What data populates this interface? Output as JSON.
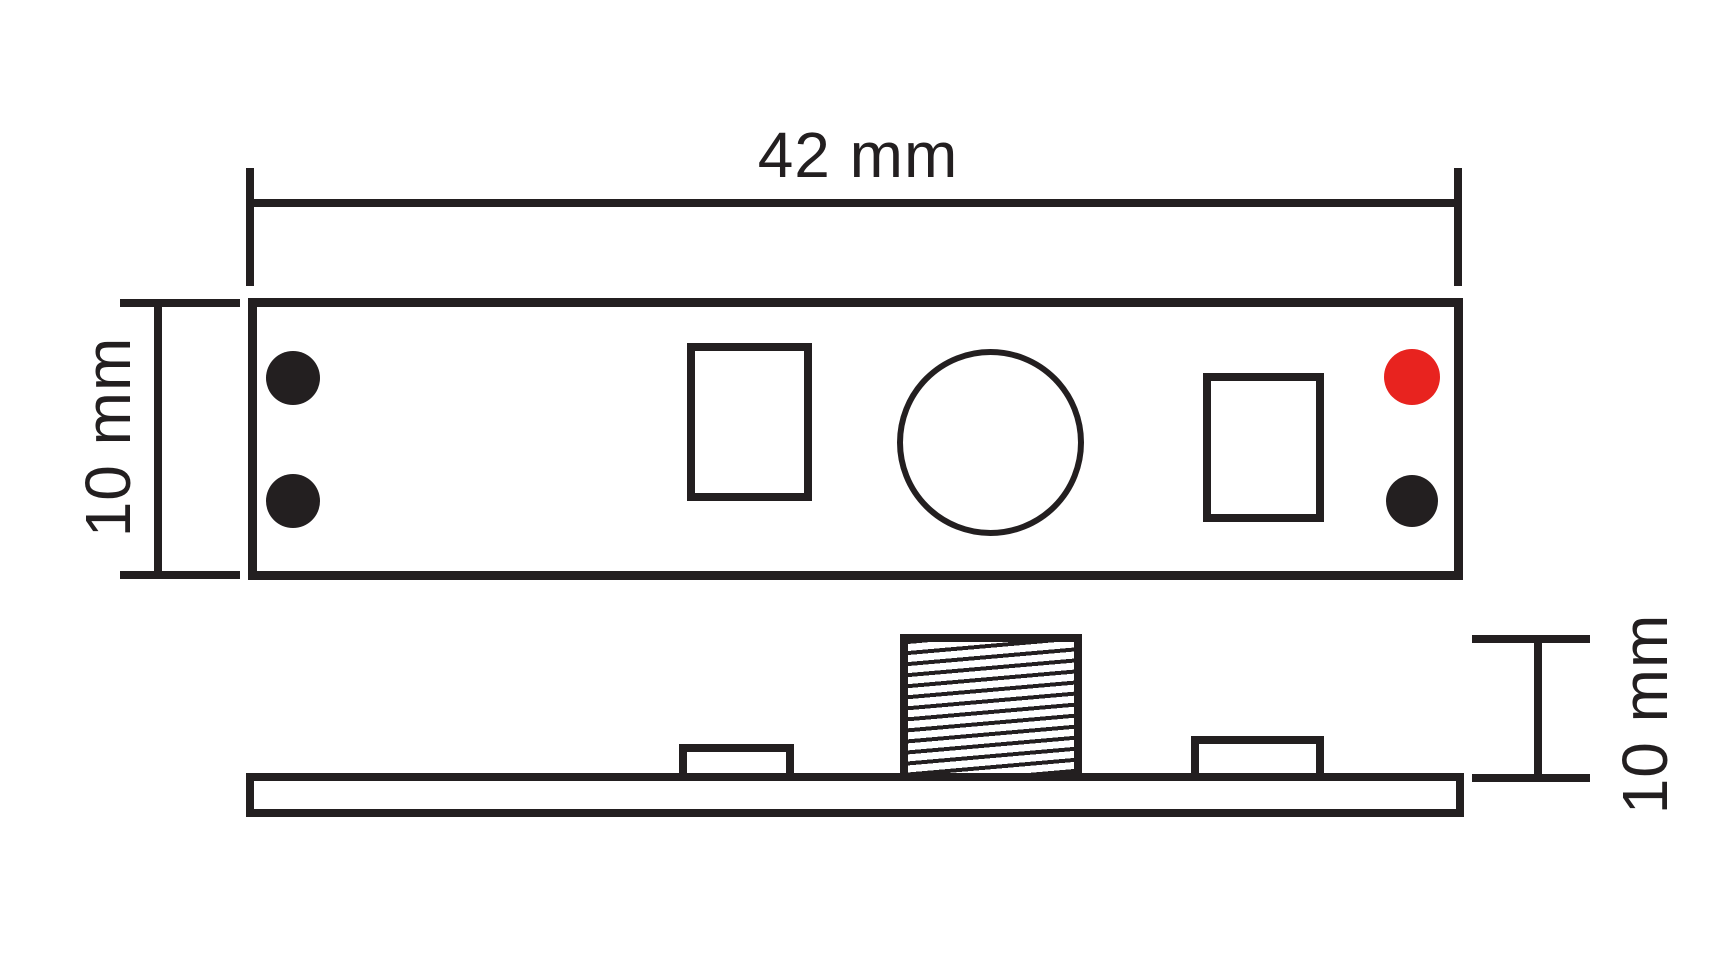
{
  "drawing": {
    "type": "technical-drawing-2-views",
    "background": "#ffffff",
    "line_color": "#231f20",
    "text_color": "#231f20",
    "pad_color": "#231f20",
    "led_color": "#e8231f",
    "top_view": {
      "width_label": "42 mm",
      "height_label": "10 mm",
      "pad_count_left": 2,
      "pad_count_right": 2
    },
    "side_view": {
      "height_label": "10 mm"
    }
  }
}
